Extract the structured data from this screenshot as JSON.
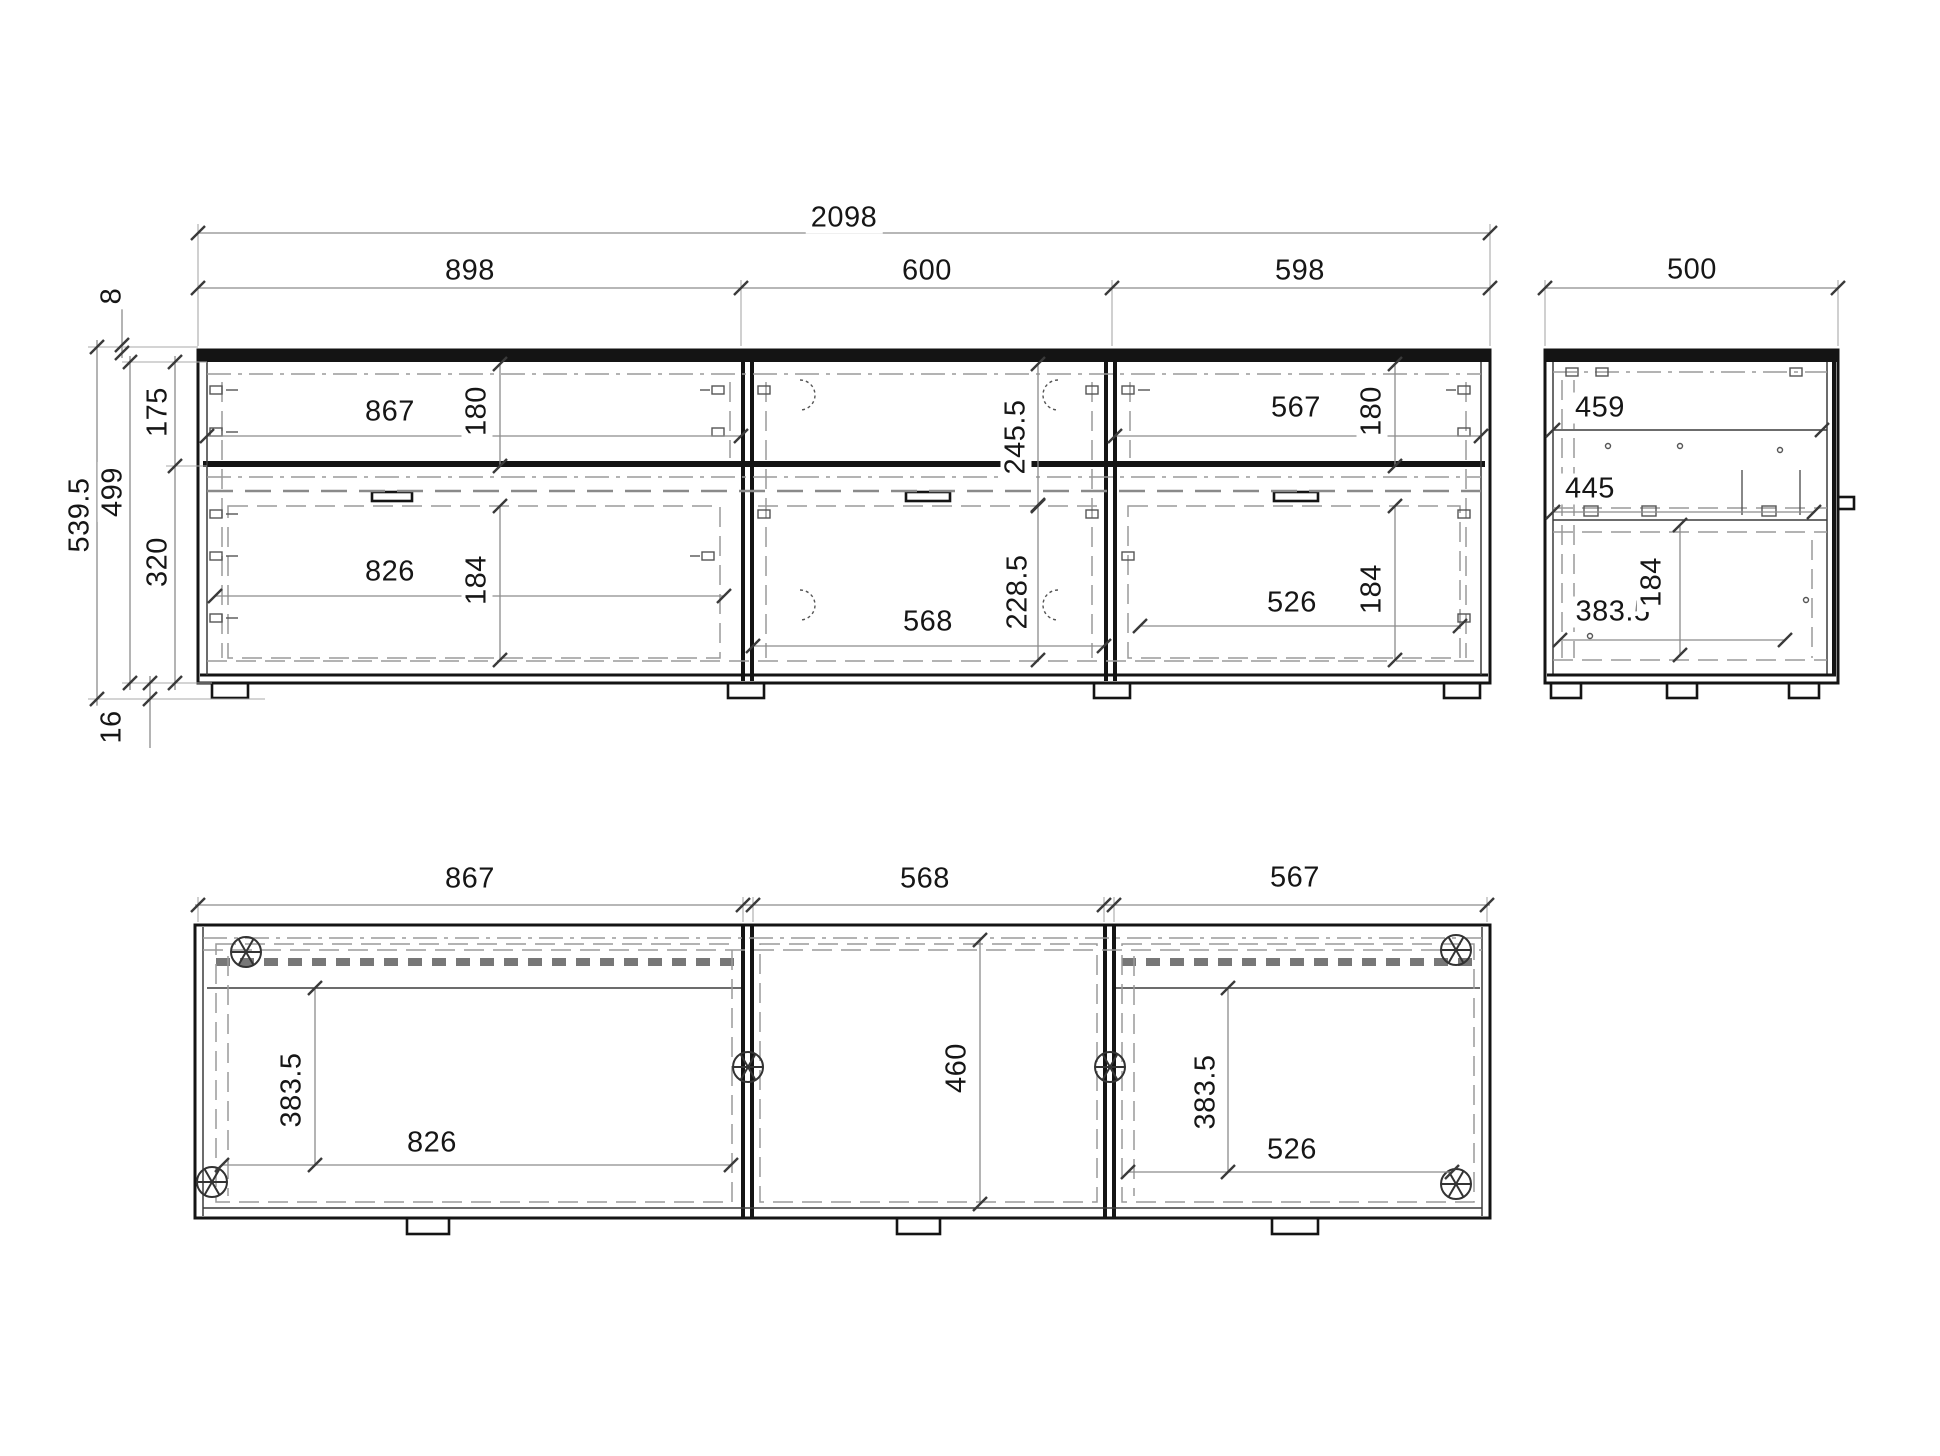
{
  "front": {
    "w_total": "2098",
    "w_left": "898",
    "w_mid": "600",
    "w_right": "598",
    "top_gap": "8",
    "h_total": "539.5",
    "h_body": "499",
    "h_top": "175",
    "h_bottom": "320",
    "h_plinth": "16",
    "drawer_l_w": "867",
    "drawer_l_h": "180",
    "mid_open_h": "245.5",
    "drawer_r_w": "567",
    "drawer_r_h": "180",
    "door_l_w": "826",
    "door_l_h": "184",
    "door_m_w": "568",
    "door_m_h": "228.5",
    "door_r_w": "526",
    "door_r_h": "184"
  },
  "side": {
    "depth": "500",
    "d_top": "459",
    "d_shelf": "445",
    "d_drawer": "383.5",
    "h_drawer": "184"
  },
  "plan": {
    "w_left": "867",
    "w_mid": "568",
    "w_right": "567",
    "d_left": "383.5",
    "w_door_l": "826",
    "d_mid": "460",
    "d_right": "383.5",
    "w_door_r": "526"
  }
}
